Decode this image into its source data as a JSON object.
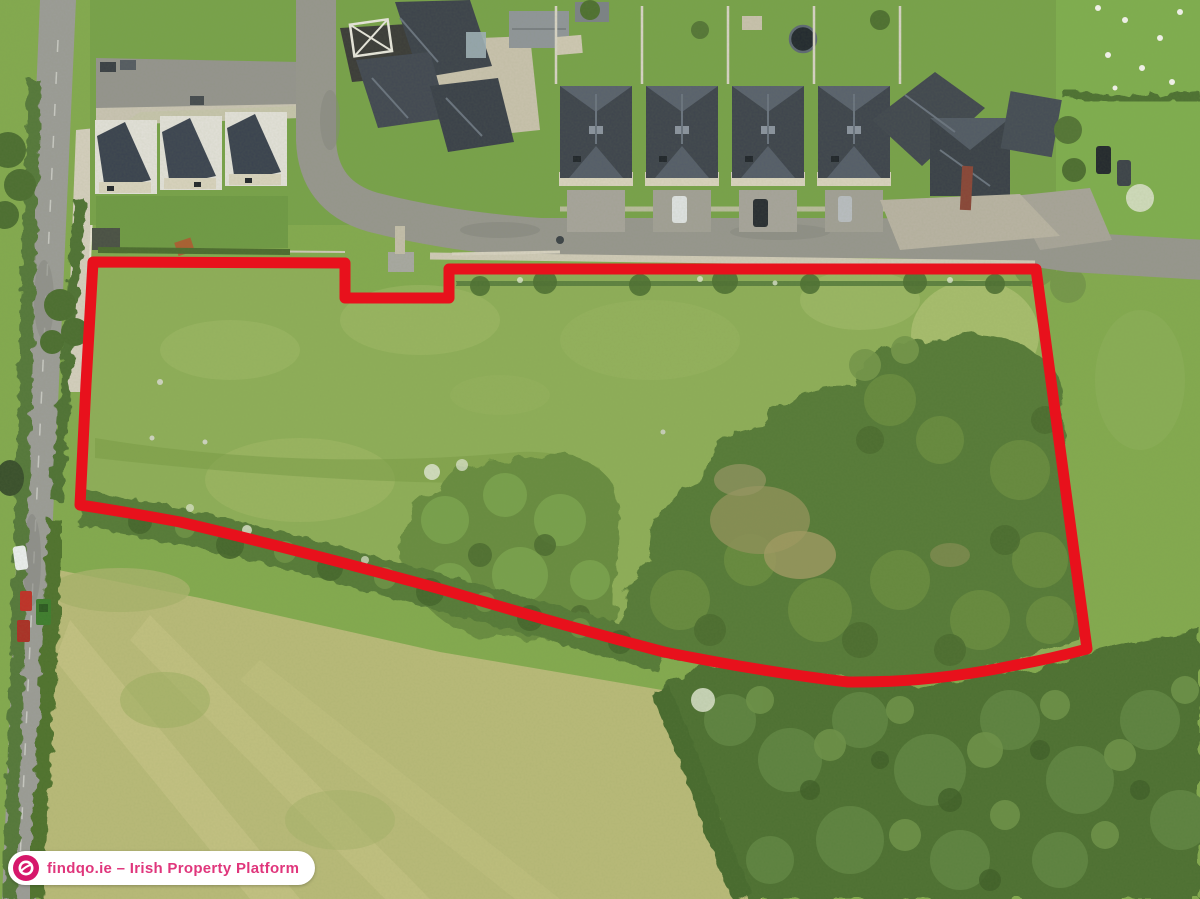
{
  "image": {
    "kind": "aerial-drone-photograph",
    "subject": "grass field site outlined in red beside a housing estate, roads, hedgerows and woodland",
    "outline_color": "#e8111c"
  },
  "watermark": {
    "icon": "findqo-logo-icon",
    "text": "findqo.ie – Irish Property Platform",
    "text_color": "#e0367c",
    "badge_background": "#ffffff",
    "logo_background": "#d6176b"
  },
  "palette": {
    "grass": "#83aa4f",
    "parcel_grass": "#8eae58",
    "pale_field": "#b9ba79",
    "woodland": "#4f7132",
    "hedge": "#55783a",
    "road": "#97968f",
    "roof": "#3e444e"
  }
}
